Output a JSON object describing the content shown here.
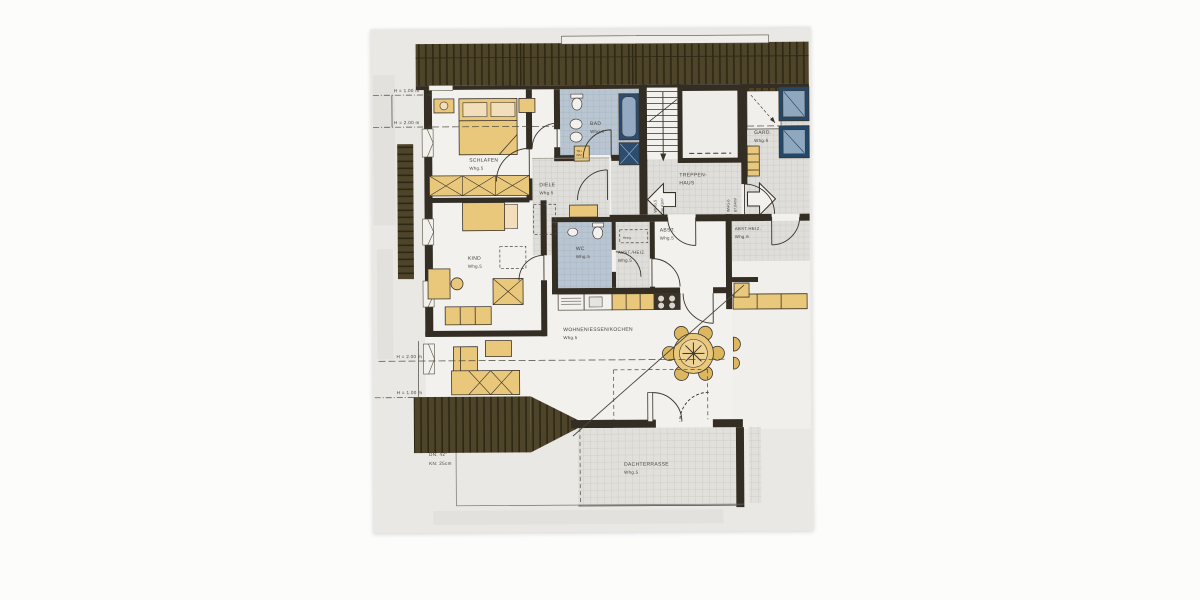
{
  "plan": {
    "dimensions": {
      "top_h1": "H = 1.00 m",
      "top_h2": "H = 2.00 m",
      "bottom_h2": "H = 2.00 m",
      "bottom_h1": "H = 1.00 m",
      "roof_pitch": "DN: 42°",
      "knee_wall": "KN: 25cm"
    },
    "apartments": {
      "whg5": {
        "label": "WHG.5",
        "area": "94.41m²"
      },
      "whg6": {
        "label": "WHG.6",
        "area": "87.84m²"
      }
    },
    "rooms": {
      "schlafen": {
        "name": "SCHLAFEN",
        "unit": "Whg.5"
      },
      "kind": {
        "name": "KIND",
        "unit": "Whg.5"
      },
      "bad": {
        "name": "BAD",
        "unit": "Whg.5"
      },
      "diele": {
        "name": "DIELE",
        "unit": "Whg.5"
      },
      "wc": {
        "name": "WC",
        "unit": "Whg.5"
      },
      "heizg": {
        "name": "Heizg."
      },
      "abst_heiz_5": {
        "name": "ABST./HEIZ.",
        "unit": "Whg.5"
      },
      "abst_5": {
        "name": "ABST.",
        "unit": "Whg.5"
      },
      "abst_heiz_6": {
        "name": "ABST.HEIZ.",
        "unit": "Whg.6"
      },
      "gard": {
        "name": "GARD.",
        "unit": "Whg.6"
      },
      "treppenhaus": {
        "line1": "TREPPEN-",
        "line2": "HAUS"
      },
      "wohnen": {
        "name": "WOHNEN/ESSEN/KOCHEN",
        "unit": "Whg.5"
      },
      "dachterrasse": {
        "name": "DACHTERRASSE",
        "unit": "Whg.5"
      }
    },
    "appliances": {
      "washer_dryer_line1": "TR+",
      "washer_dryer_line2": "WM"
    },
    "palette": {
      "roof": "#4e4429",
      "wall": "#332d24",
      "furniture": "#e9c87c",
      "bath_fixture": "#2c4d70",
      "bath_floor": "#bac6d2",
      "tile_floor": "#e0dfda",
      "paper": "#eae8e4"
    }
  }
}
